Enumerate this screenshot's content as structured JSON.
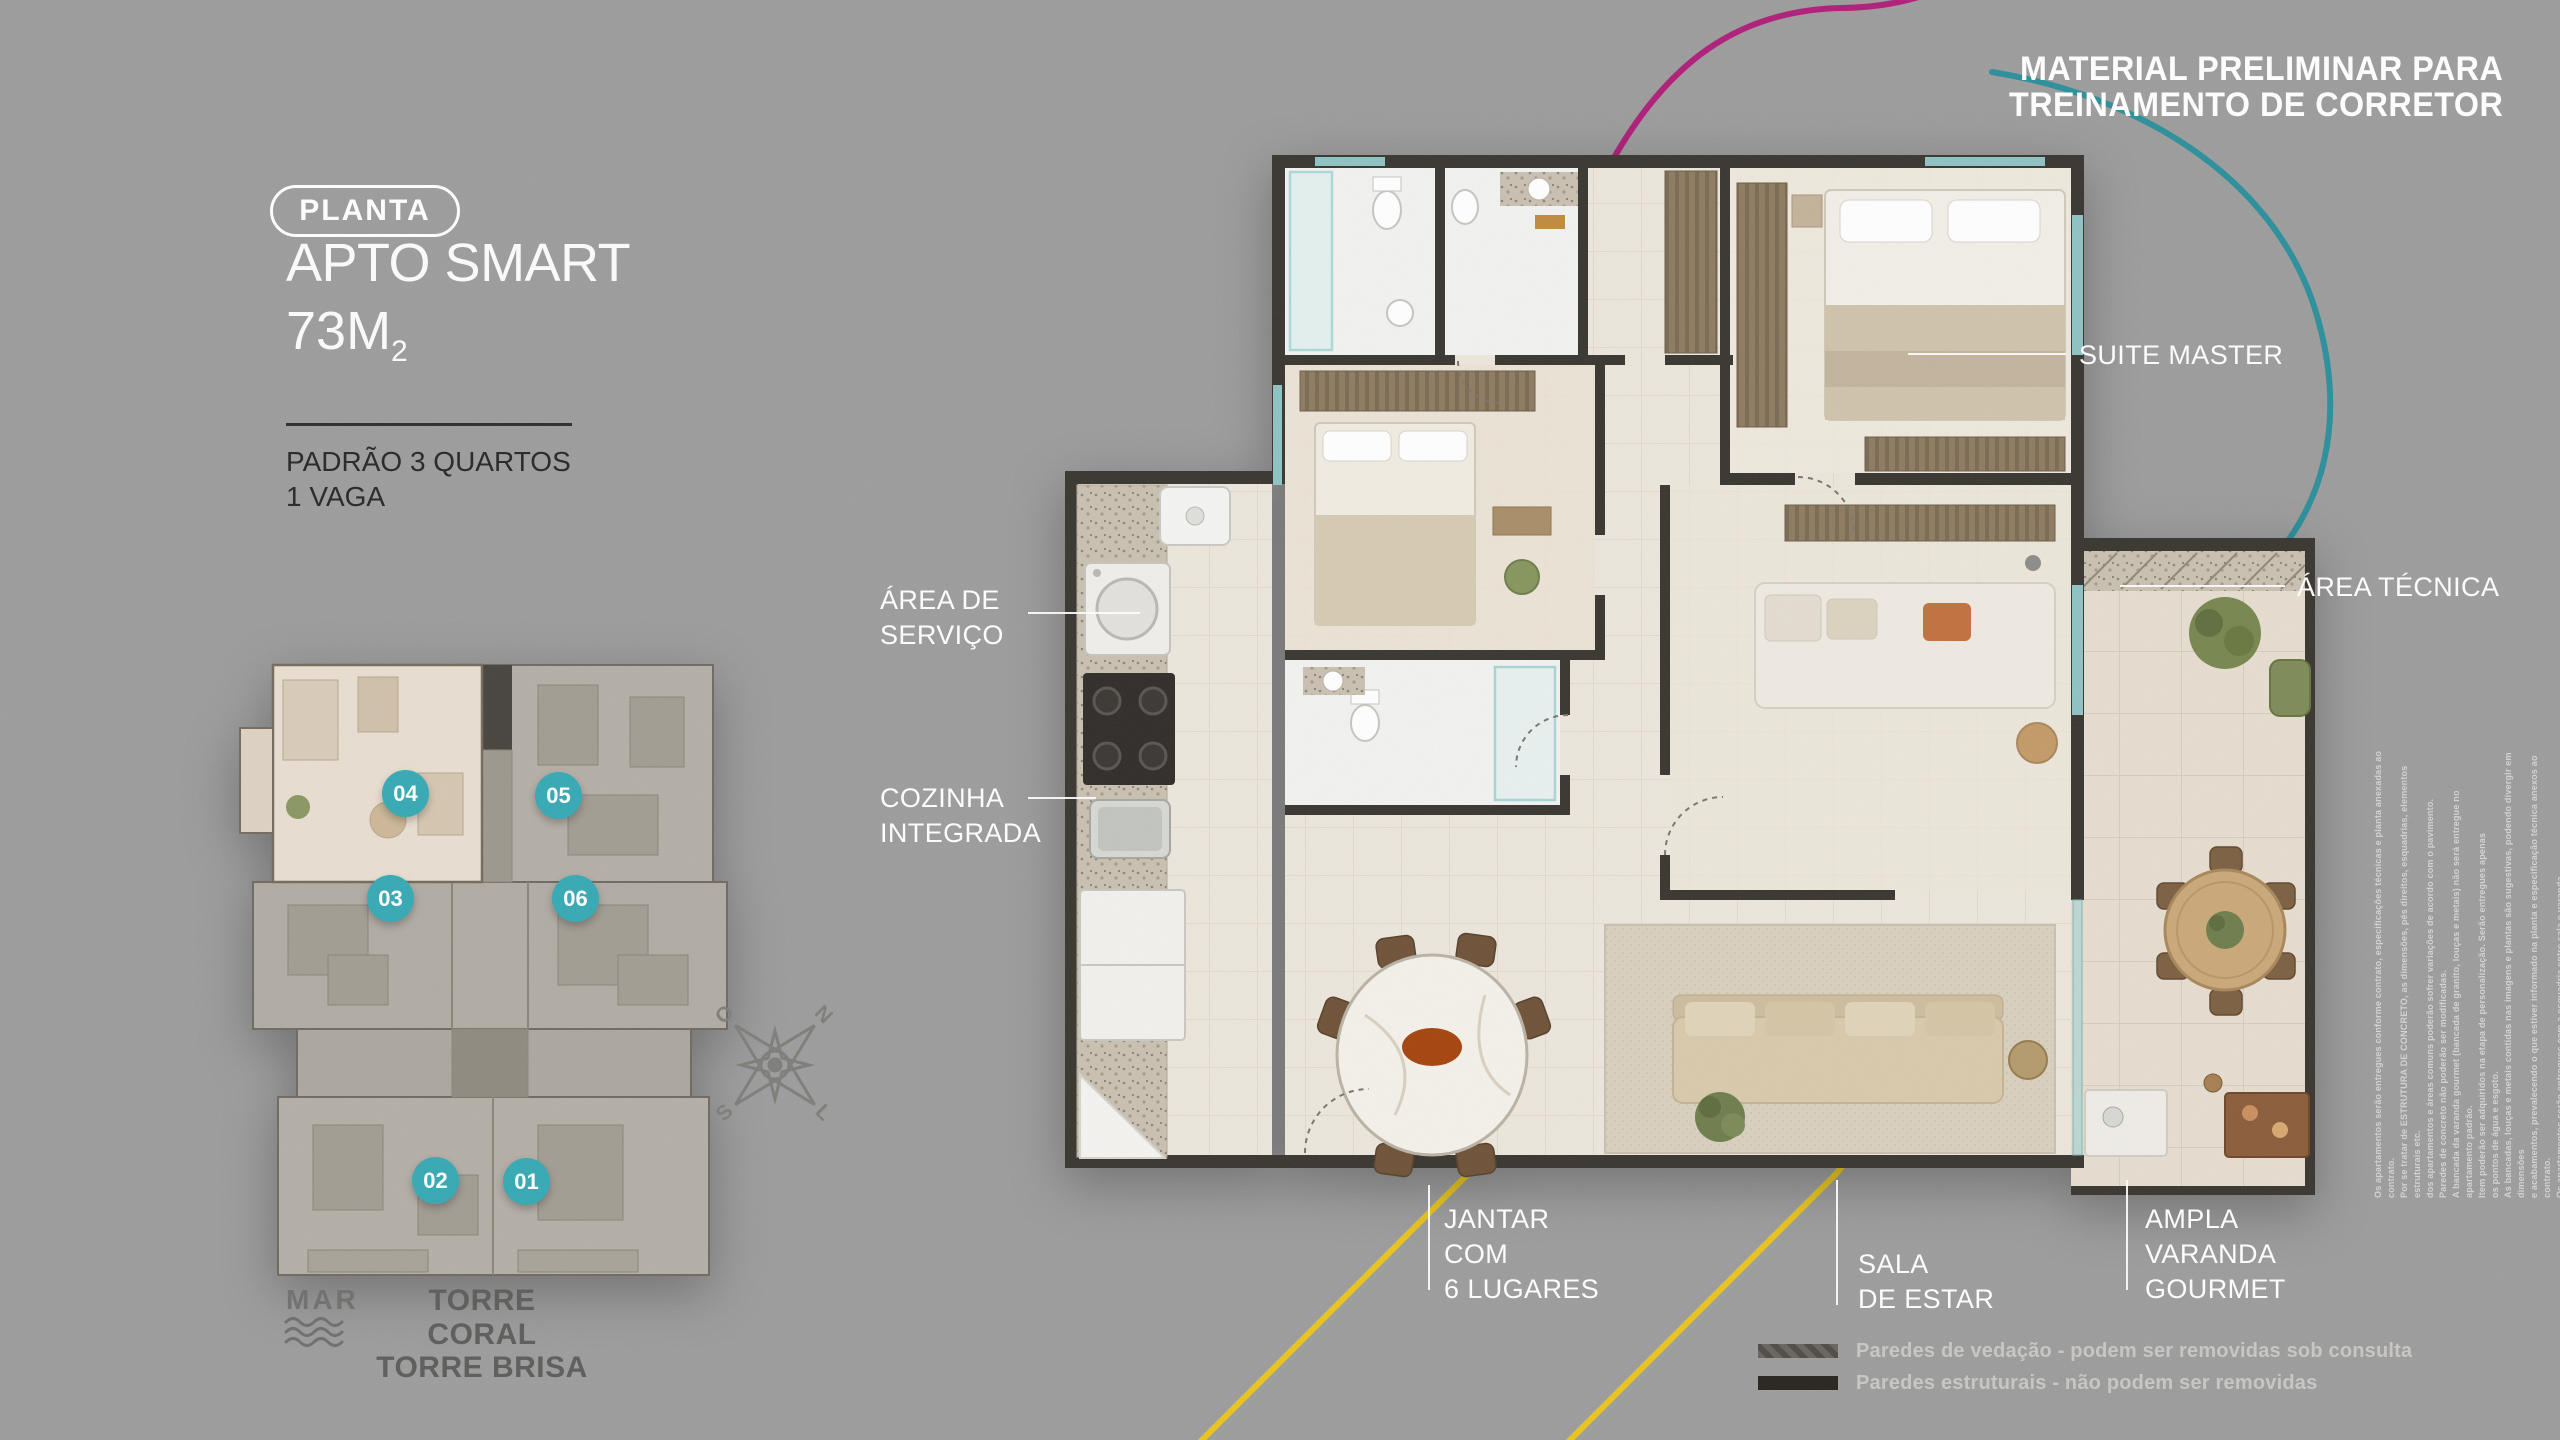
{
  "training_notice": {
    "line1": "MATERIAL PRELIMINAR PARA",
    "line2": "TREINAMENTO DE CORRETOR"
  },
  "title_block": {
    "badge": "PLANTA",
    "title": "APTO SMART",
    "area_value": "73M",
    "area_sub": "2",
    "spec_line1": "PADRÃO 3 QUARTOS",
    "spec_line2": "1 VAGA"
  },
  "key_plate": {
    "highlighted_unit": "04",
    "units": [
      {
        "number": "04"
      },
      {
        "number": "05"
      },
      {
        "number": "03"
      },
      {
        "number": "06"
      },
      {
        "number": "02"
      },
      {
        "number": "01"
      }
    ],
    "sea_label": "MAR",
    "towers_line1": "TORRE CORAL",
    "towers_line2": "TORRE BRISA",
    "compass": {
      "n": "N",
      "s": "S",
      "l": "L",
      "o": "O"
    }
  },
  "plan_labels": {
    "suite_master": "SUITE MASTER",
    "area_tecnica": "ÁREA TÉCNICA",
    "area_servico": [
      "ÁREA DE",
      "SERVIÇO"
    ],
    "cozinha": [
      "COZINHA",
      "INTEGRADA"
    ],
    "jantar": [
      "JANTAR",
      "COM",
      "6 LUGARES"
    ],
    "sala": [
      "SALA",
      "DE ESTAR"
    ],
    "varanda": [
      "AMPLA",
      "VARANDA",
      "GOURMET"
    ]
  },
  "legend": {
    "items": [
      {
        "label": "Paredes de vedação - podem ser removidas sob consulta",
        "color": "#5a574f"
      },
      {
        "label": "Paredes estruturais - não podem ser removidas",
        "color": "#26231e"
      }
    ]
  },
  "fine_print": {
    "lines": [
      "Os apartamentos serão entregues conforme contrato, especificações técnicas e planta anexadas ao contrato.",
      "Por se tratar de ESTRUTURA DE CONCRETO, as dimensões, pés direitos, esquadrias, elementos estruturais etc.",
      "dos apartamentos e áreas comuns poderão sofrer variações de acordo com o pavimento.",
      "Paredes de concreto não poderão ser modificadas.",
      "A bancada da varanda gourmet (bancada de granito, louças e metais) não será entregue no apartamento padrão.",
      "Item poderão ser adquiridos na etapa de personalização. Serão entregues apenas",
      "os pontos de água e esgoto.",
      "As bancadas, louças e metais contidas nas imagens e plantas são sugestivas, podendo divergir em dimensões",
      "e acabamentos, prevalecendo o que estiver informado na planta e especificação técnica anexos ao contrato.",
      "Os apartamentos serão entregues com a esquadria entre sala e varanda."
    ]
  },
  "colors": {
    "background": "#9c9c9c",
    "accent_magenta": "#b01d79",
    "accent_teal": "#2a8f9b",
    "accent_yellow": "#e9c51c",
    "badge_teal": "#35a9b4",
    "wall_dark": "#38352f",
    "floor_light": "#ece6dc"
  }
}
